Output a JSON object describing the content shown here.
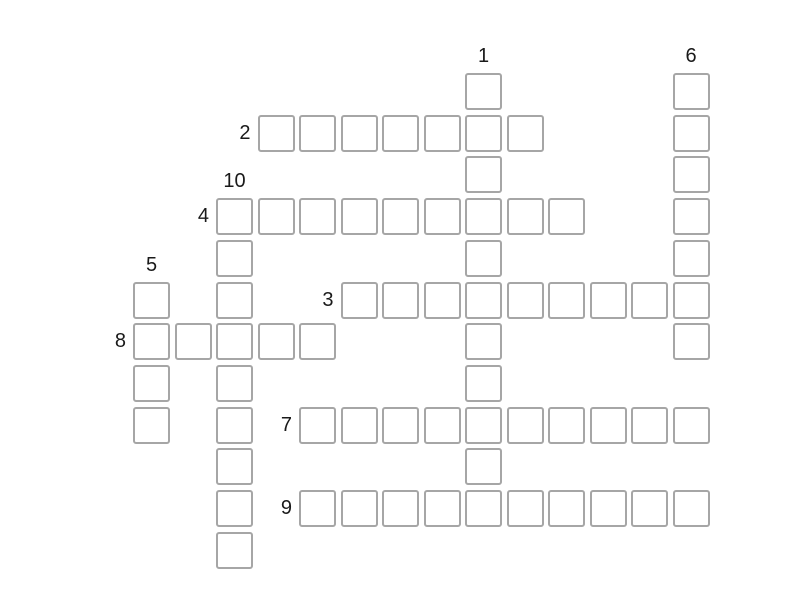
{
  "puzzle": {
    "type": "crossword",
    "background_color": "#ffffff",
    "canvas": {
      "width": 800,
      "height": 600
    },
    "grid": {
      "origin_x": 133,
      "origin_y": 73,
      "pitch_x": 41.5,
      "pitch_y": 41.7,
      "columns": 14,
      "rows": 12
    },
    "cell": {
      "size": 37,
      "fill": "#ffffff",
      "border_color": "#a6a6a6",
      "border_width": 2,
      "border_radius": 3,
      "value": ""
    },
    "label_style": {
      "color": "#1a1a1a",
      "font_size": 20
    },
    "words": [
      {
        "number": "1",
        "direction": "down",
        "col": 8,
        "row": 0,
        "length": 11
      },
      {
        "number": "2",
        "direction": "across",
        "col": 3,
        "row": 1,
        "length": 7
      },
      {
        "number": "3",
        "direction": "across",
        "col": 5,
        "row": 5,
        "length": 9
      },
      {
        "number": "4",
        "direction": "across",
        "col": 2,
        "row": 3,
        "length": 9
      },
      {
        "number": "5",
        "direction": "down",
        "col": 0,
        "row": 5,
        "length": 4
      },
      {
        "number": "6",
        "direction": "down",
        "col": 13,
        "row": 0,
        "length": 7
      },
      {
        "number": "7",
        "direction": "across",
        "col": 4,
        "row": 8,
        "length": 10
      },
      {
        "number": "8",
        "direction": "across",
        "col": 0,
        "row": 6,
        "length": 5
      },
      {
        "number": "9",
        "direction": "across",
        "col": 4,
        "row": 10,
        "length": 10
      },
      {
        "number": "10",
        "direction": "down",
        "col": 2,
        "row": 3,
        "length": 9
      }
    ]
  }
}
